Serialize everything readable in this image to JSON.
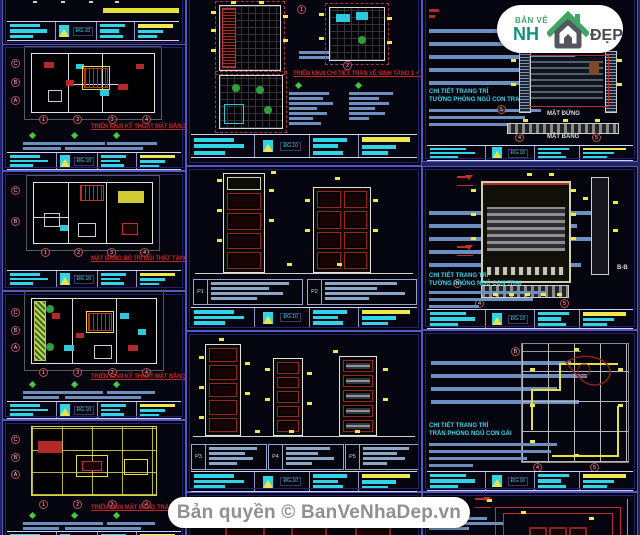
{
  "branding": {
    "logo": {
      "top": "BẢN VẼ",
      "name_left": "NH",
      "name_right": "ĐẸP",
      "green": "#3fa565",
      "teal": "#12917e",
      "gray": "#4a4a52"
    },
    "footer": {
      "text": "Bản quyền © BanVeNhaDep.vn"
    }
  },
  "title_block": {
    "sheet_code": "ĐG.10"
  },
  "sheets": {
    "l2": {
      "caption": "TRIỂN KHAI KỸ THUẬT MẶT BẰNG TẦNG 1",
      "cols": [
        "1",
        "2",
        "3",
        "4"
      ],
      "rows": [
        "C",
        "B",
        "A"
      ]
    },
    "l3": {
      "caption": "MẶT BẰNG BỐ TRÍ NỘI THẤT TẦNG 2",
      "cols": [
        "1",
        "2",
        "3",
        "4"
      ],
      "rows": [
        "C",
        "B"
      ]
    },
    "l4": {
      "caption": "TRIỂN KHAI KỸ THUẬT MẶT BẰNG TẦNG 3",
      "cols": [
        "1",
        "2",
        "3",
        "4"
      ],
      "rows": [
        "C",
        "B",
        "A"
      ]
    },
    "l5": {
      "caption": "TRIỂN KHAI MẶT BẰNG TRẦN TẦNG 1",
      "cols": [
        "1",
        "2",
        "3",
        "4"
      ],
      "rows": [
        "C",
        "B",
        "A"
      ]
    },
    "m1": {
      "caption": "TRIỂN KHAI CHI TIẾT TRẦN VỆ SINH TẦNG 1 + TẦNG 2",
      "b1": [
        "1"
      ],
      "b2": [
        "2"
      ]
    },
    "m2": {
      "codes": [
        "P1",
        "P2"
      ]
    },
    "m3": {
      "codes": [
        "P3",
        "P4",
        "P5"
      ]
    },
    "r1": {
      "title1": "CHI TIẾT TRANG TRÍ",
      "title2": "TƯỜNG PHÒNG NGỦ CON TRAI",
      "label_elev": "MẶT ĐỨNG",
      "label_plan": "MẶT BẰNG",
      "side": [
        "5"
      ],
      "bottom": [
        "4",
        "5"
      ]
    },
    "r2": {
      "title1": "CHI TIẾT TRANG TRÍ",
      "title2": "TƯỜNG PHÒNG NGỦ CON TRAI",
      "section_label": "B-B",
      "side": [
        "B"
      ],
      "bottom": [
        "4",
        "5"
      ]
    },
    "r3": {
      "title1": "CHI TIẾT TRANG TRÍ",
      "title2": "TRẦN PHÒNG NGỦ CON GÁI",
      "top": [
        "B"
      ],
      "bottom": [
        "4",
        "5"
      ]
    }
  }
}
